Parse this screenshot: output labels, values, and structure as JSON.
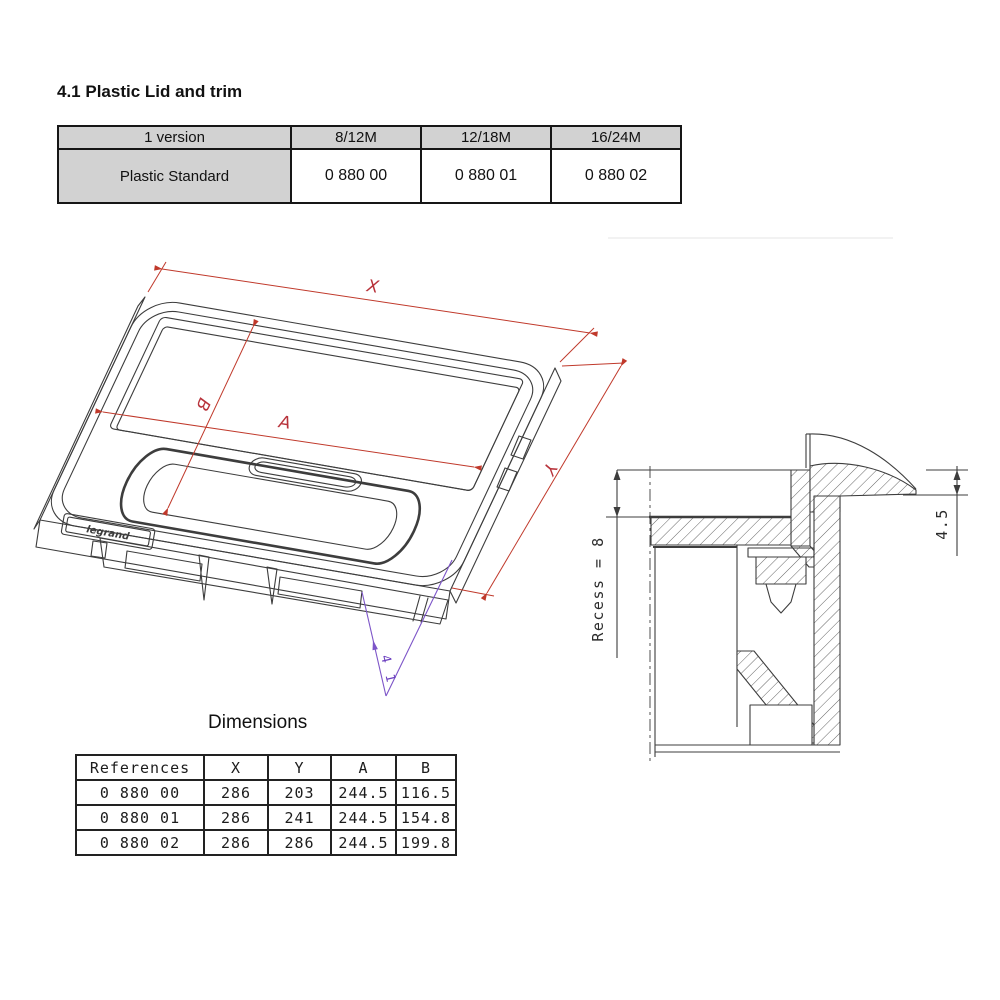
{
  "page": {
    "heading": "4.1 Plastic Lid and trim",
    "dimensions_title": "Dimensions"
  },
  "version_table": {
    "headers": [
      "1 version",
      "8/12M",
      "12/18M",
      "16/24M"
    ],
    "row_label": "Plastic Standard",
    "row_values": [
      "0 880 00",
      "0 880 01",
      "0 880 02"
    ]
  },
  "dimensions_table": {
    "headers": [
      "References",
      "X",
      "Y",
      "A",
      "B"
    ],
    "rows": [
      [
        "0 880 00",
        "286",
        "203",
        "244.5",
        "116.5"
      ],
      [
        "0 880 01",
        "286",
        "241",
        "244.5",
        "154.8"
      ],
      [
        "0 880 02",
        "286",
        "286",
        "244.5",
        "199.8"
      ]
    ]
  },
  "iso_drawing": {
    "logo": "legrand",
    "labels": {
      "width": "X",
      "depth": "Y",
      "inner_width": "A",
      "inner_depth": "B",
      "below_depth": "4 1"
    },
    "colors": {
      "dimension_red": "#c0392b",
      "dimension_purple": "#7d55c8",
      "drawing_line": "#3d3d3d"
    }
  },
  "section_drawing": {
    "recess_label": "Recess = 8",
    "lip_label": "4.5"
  }
}
